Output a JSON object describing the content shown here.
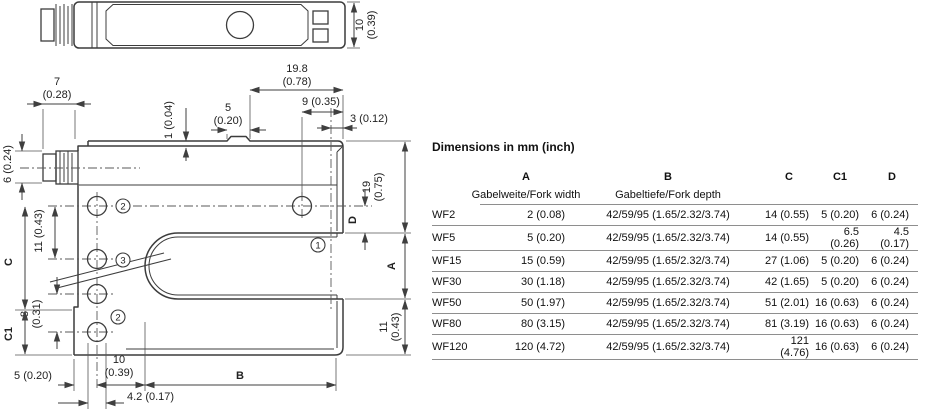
{
  "table": {
    "title": "Dimensions in mm (inch)",
    "columns": {
      "a": "A",
      "b": "B",
      "c": "C",
      "c1": "C1",
      "d": "D"
    },
    "subheaders": {
      "a": "Gabelweite/Fork width",
      "b": "Gabeltiefe/Fork depth"
    },
    "rows": [
      {
        "model": "WF2",
        "a": "2 (0.08)",
        "b": "42/59/95 (1.65/2.32/3.74)",
        "c": "14 (0.55)",
        "c1": "5 (0.20)",
        "d": "6 (0.24)"
      },
      {
        "model": "WF5",
        "a": "5 (0.20)",
        "b": "42/59/95 (1.65/2.32/3.74)",
        "c": "14 (0.55)",
        "c1": "6.5 (0.26)",
        "d": "4.5 (0.17)"
      },
      {
        "model": "WF15",
        "a": "15 (0.59)",
        "b": "42/59/95 (1.65/2.32/3.74)",
        "c": "27 (1.06)",
        "c1": "5 (0.20)",
        "d": "6 (0.24)"
      },
      {
        "model": "WF30",
        "a": "30 (1.18)",
        "b": "42/59/95 (1.65/2.32/3.74)",
        "c": "42 (1.65)",
        "c1": "5 (0.20)",
        "d": "6 (0.24)"
      },
      {
        "model": "WF50",
        "a": "50 (1.97)",
        "b": "42/59/95 (1.65/2.32/3.74)",
        "c": "51 (2.01)",
        "c1": "16 (0.63)",
        "d": "6 (0.24)"
      },
      {
        "model": "WF80",
        "a": "80 (3.15)",
        "b": "42/59/95 (1.65/2.32/3.74)",
        "c": "81 (3.19)",
        "c1": "16 (0.63)",
        "d": "6 (0.24)"
      },
      {
        "model": "WF120",
        "a": "120 (4.72)",
        "b": "42/59/95 (1.65/2.32/3.74)",
        "c": "121 (4.76)",
        "c1": "16 (0.63)",
        "d": "6 (0.24)"
      }
    ]
  },
  "drawing": {
    "top_view": {
      "tv10_l1": "10",
      "tv10_l2": "(0.39)"
    },
    "dims": {
      "d7_l1": "7",
      "d7_l2": "(0.28)",
      "d198_l1": "19.8",
      "d198_l2": "(0.78)",
      "d9": "9 (0.35)",
      "d5t_l1": "5",
      "d5t_l2": "(0.20)",
      "d3": "3 (0.12)",
      "d1": "1 (0.04)",
      "d6": "6 (0.24)",
      "d19_l1": "19",
      "d19_l2": "(0.75)",
      "dD": "D",
      "dA": "A",
      "d11r_l1": "11",
      "d11r_l2": "(0.43)",
      "d11l": "11 (0.43)",
      "d8_l1": "8",
      "d8_l2": "(0.31)",
      "dC": "C",
      "dC1": "C1",
      "d5b": "5 (0.20)",
      "d10_l1": "10",
      "d10_l2": "(0.39)",
      "d42": "4.2 (0.17)",
      "dB": "B"
    },
    "markers": {
      "m1": "1",
      "m2": "2",
      "m3": "3"
    }
  }
}
